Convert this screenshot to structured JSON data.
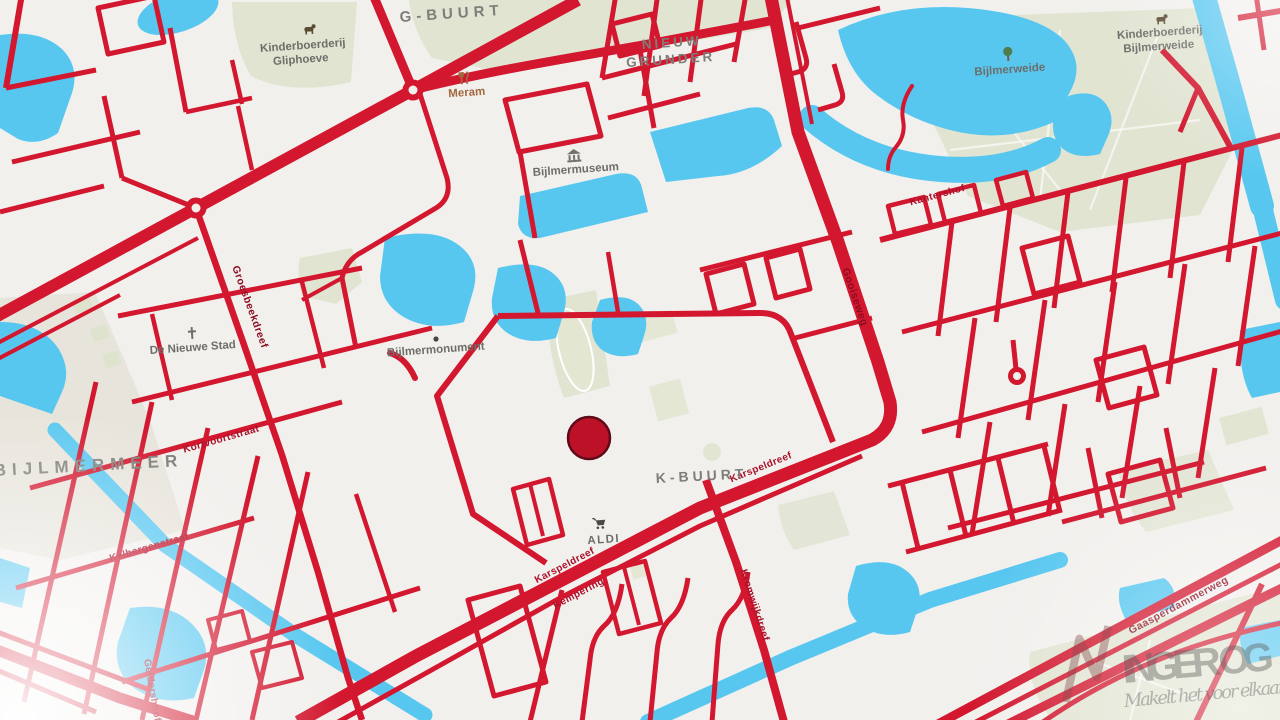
{
  "map": {
    "colors": {
      "land": "#f2f0ed",
      "water": "#58c7f0",
      "park": "#e1e4d1",
      "road": "#d2172f",
      "street_label": "#a9112a",
      "poi_label": "#6e6d69",
      "area_label": "#7e7d79",
      "marker": "#bc1127"
    },
    "area_labels": {
      "g_buurt": {
        "text": "G-BUURT"
      },
      "nieuw_grunder": {
        "line1": "NIEUW",
        "line2": "GRUNDER"
      },
      "bijlmermeer": {
        "text": "BIJLMERMEER"
      },
      "k_buurt": {
        "text": "K-BUURT"
      }
    },
    "poi_labels": {
      "gliphoeve": {
        "line1": "Kinderboerderij",
        "line2": "Gliphoeve",
        "icon": "farm-animal-icon"
      },
      "meram": {
        "text": "Meram",
        "icon": "restaurant-icon"
      },
      "bijlmermuseum": {
        "text": "Bijlmermuseum",
        "icon": "museum-icon"
      },
      "bijlmerweide": {
        "text": "Bijlmerweide",
        "icon": "tree-icon"
      },
      "kinderboerderij_bijlmerweide": {
        "line1": "Kinderboerderij",
        "line2": "Bijlmerweide",
        "icon": "farm-animal-icon"
      },
      "de_nieuwe_stad": {
        "text": "De Nieuwe Stad",
        "icon": "church-cross-icon"
      },
      "bijlmermonument": {
        "text": "Bijlmermonument",
        "icon": "monument-dot-icon"
      },
      "aldi": {
        "text": "ALDI",
        "icon": "shopping-cart-icon"
      }
    },
    "street_labels": {
      "karspeldreef_w": "Karspeldreef",
      "kempering": "Kempering",
      "karspeldreef_e": "Karspeldreef",
      "kromwijkdreef": "Kromwijkdreef",
      "kantershof": "Kantershof",
      "gooiseweg": "Gooiseweg",
      "groesbeekdreef": "Groesbeekdreef",
      "kortvoortstraat": "Kortvoortstraat",
      "kelbergenstraat": "Kelbergenstraat",
      "geldershoofd": "Geldershoofd",
      "gaasperdammerweg": "Gaasperdammerweg"
    },
    "marker": {
      "color": "#bc1127"
    },
    "watermark": {
      "brand": "INGER OG",
      "tagline": "Makelt het voor elkaar!"
    }
  }
}
